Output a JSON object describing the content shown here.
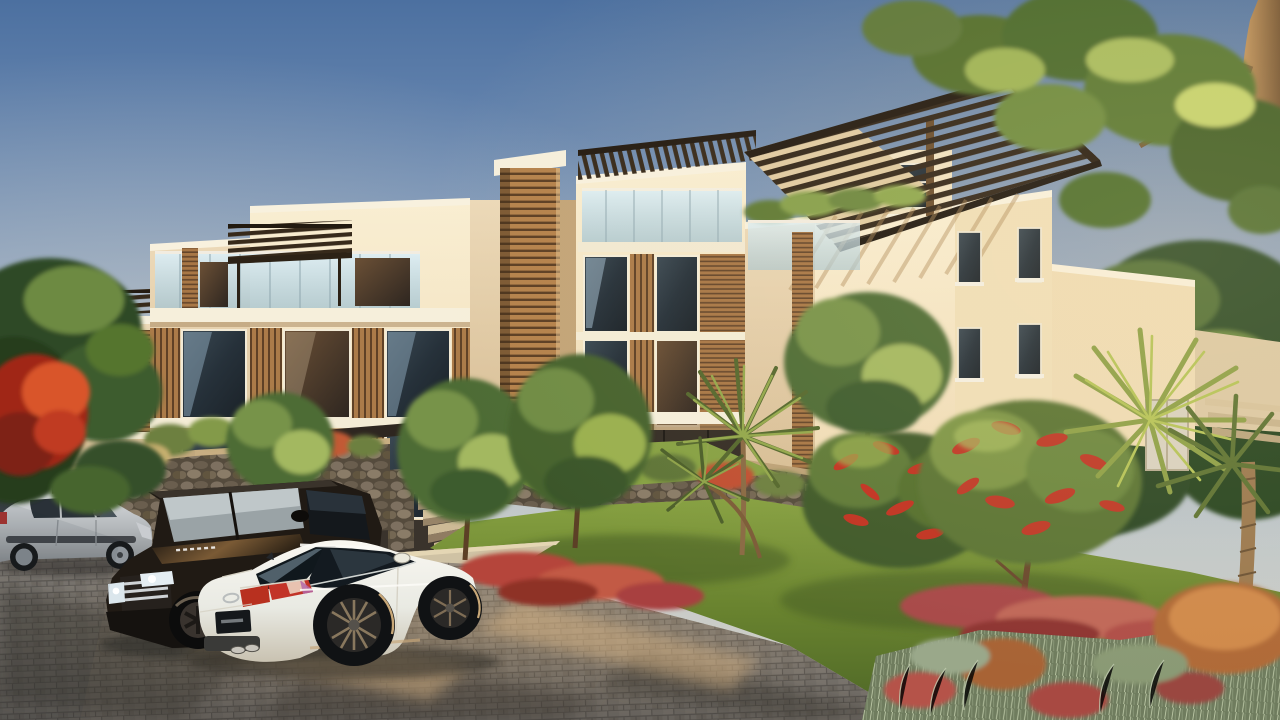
{
  "scene": {
    "type": "photorealistic architectural rendering",
    "description": "Golden-hour exterior rendering of a modern three-storey apartment complex with cream stucco walls, timber louver cladding and rooftop pergolas, fronted by tropical landscaping, rubble-stone garden walls and a paved parking area with parked cars.",
    "time_of_day": "late afternoon golden hour",
    "weather": "clear sky",
    "palette": {
      "sky_top": "#4c70a0",
      "sky_mid": "#8aa3c4",
      "sky_horizon": "#d8d2c2",
      "wall_lit": "#f6e7c4",
      "wall_shaded": "#e4cfae",
      "timber": "#b5824c",
      "timber_gap": "#5d3f24",
      "pergola_wood": "#33271a",
      "glass_dark": "#2c363c",
      "glass_reflection": "#a9c4d6",
      "balcony_glass": "#cfe3ea",
      "stone_wall": "#6f6352",
      "lawn": "#6f8a38",
      "flower_red": "#c0392a",
      "groundcover_red": "#b05048",
      "russet_grass": "#b06a38",
      "foliage_dark": "#3e5c2e",
      "foliage_light": "#9fb457",
      "pavement": "#8e8880",
      "pavement_shadow": "#4f4b46",
      "walkway": "#cfc2a4"
    },
    "building": {
      "description": "Stepped row of flat-roofed apartment blocks with cream rendered walls, dark-framed windows, frosted glass balustrades, timber louver panels, a timber-clad stair tower and dark timber pergola canopies over the roof terraces.",
      "blocks": [
        {
          "name": "far-left-low-block"
        },
        {
          "name": "left-terrace-block"
        },
        {
          "name": "timber-stair-tower"
        },
        {
          "name": "centre-balcony-block"
        },
        {
          "name": "right-corner-tower"
        },
        {
          "name": "background-right-wing"
        }
      ],
      "features": [
        "rooftop pergolas",
        "glass balustrades",
        "timber louvers",
        "recessed dark-glass ground floor",
        "roof terrace planting"
      ]
    },
    "vehicles": [
      {
        "name": "dark-vehicle-edge",
        "description": "dark vehicle cropped at the left image edge",
        "color": "#23201d"
      },
      {
        "name": "silver-hatchback",
        "description": "silver five-door hatchback parked side-on facing right",
        "color": "#c0c4c8"
      },
      {
        "name": "black-suv",
        "description": "black luxury SUV at three-quarter front view with headlights catching the sun and an illegible white licence plate",
        "color": "#1e1a16"
      },
      {
        "name": "white-sedan",
        "description": "white sports sedan in the foreground seen from the rear three-quarter, dark alloy wheels, red tail lights, dark illegible licence plate",
        "color": "#f2f1ea"
      }
    ],
    "landscape": {
      "elements": [
        {
          "name": "rubble-stone-walls",
          "description": "low dry-stacked stone retaining walls along the building base"
        },
        {
          "name": "stone-stairs",
          "description": "sandstone steps climbing from the walkway to the entrance"
        },
        {
          "name": "lawn",
          "description": "sunlit lawn sweeping to the right of the parking area"
        },
        {
          "name": "red-flower-beds",
          "description": "beds of red and magenta flowering groundcover"
        },
        {
          "name": "bottlebrush-tree",
          "description": "small trees covered in red bottlebrush blossom"
        },
        {
          "name": "green-trees",
          "description": "round-canopy green trees in front of the facade"
        },
        {
          "name": "palms",
          "description": "fan palms on the right and a yucca cluster mid-garden"
        },
        {
          "name": "ornamental-grasses",
          "description": "grey-green and russet ornamental grass mounds in the right foreground"
        },
        {
          "name": "big-tree",
          "description": "large tree trunk with backlit canopy overhanging the top right corner"
        },
        {
          "name": "paved-parking",
          "description": "grey interlocking paver parking area with long warm shadows"
        }
      ]
    },
    "lighting": {
      "description": "warm low sun from the right casting long shadows and golden highlights",
      "sun_direction": "right"
    }
  }
}
